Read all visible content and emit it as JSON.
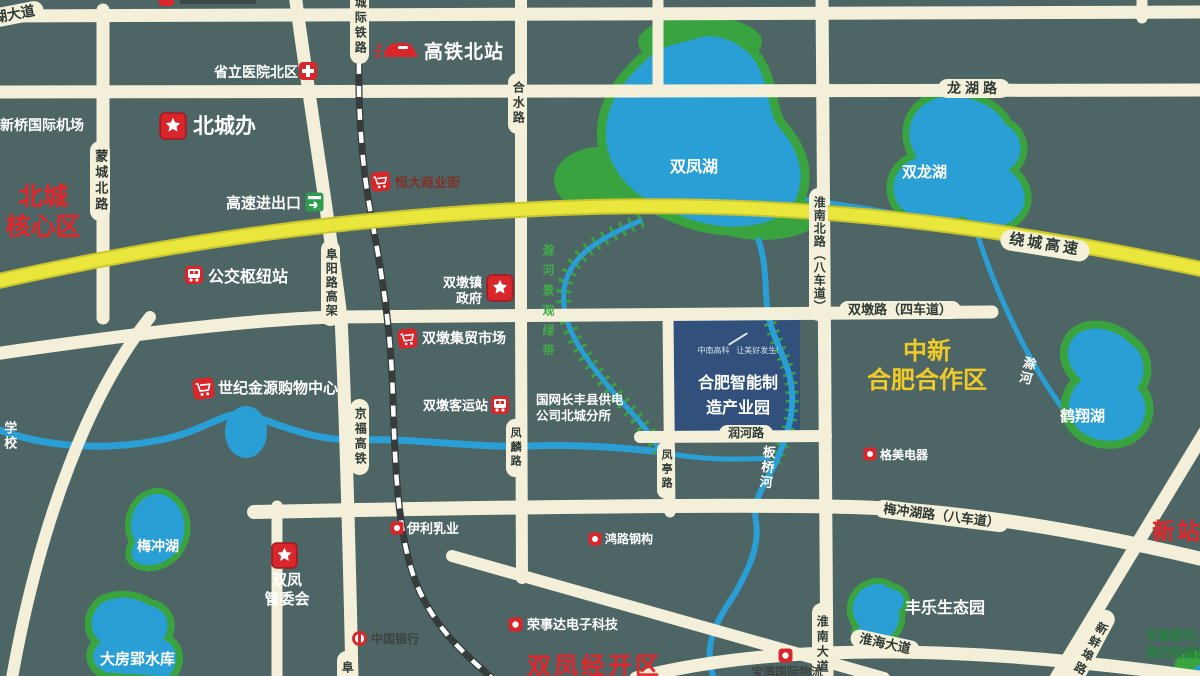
{
  "regions": {
    "beicheng_core": {
      "line1": "北城",
      "line2": "核心区"
    },
    "zhongxin_coop": {
      "line1": "中新",
      "line2": "合肥合作区"
    },
    "xinzhan": {
      "label": "新站区"
    },
    "shuangfeng_edz": {
      "label": "双凤经开区"
    }
  },
  "park": {
    "logo": "中南高科",
    "slogan": "让美好发生!",
    "name_line1": "合肥智能制",
    "name_line2": "造产业园"
  },
  "lakes": {
    "shuangfeng": "双凤湖",
    "shuanglong": "双龙湖",
    "hexiang": "鹤翔湖",
    "meichong": "梅冲湖",
    "dafangying": "大房郢水库"
  },
  "rivers": {
    "banqiao": "板桥河",
    "chu": "滁河",
    "greenway": "滁河景观绿带"
  },
  "roads": {
    "hudadao": "湖大道",
    "longhu": "龙湖路",
    "mengchengbei": "蒙城北路",
    "heshui": "合水路",
    "fuyang_viaduct": "阜阳路高架",
    "fuyang_partial": "阜",
    "chengji_railway": "城际铁路",
    "jingfu_hsr": "京福高铁",
    "raocheng_expwy": "绕城高速",
    "expwy_entrance": "高速进出口",
    "huainanbei": "淮南北路（八车道）",
    "shuangdun": "双墩路（四车道）",
    "runhe": "润河路",
    "fenglin": "凤麟路",
    "fengting": "凤亭路",
    "meichonghu_rd": "梅冲湖路（八车道）",
    "huainan_ave": "淮南大道",
    "huaihai_ave": "淮海大道",
    "xinbengbu": "新蚌埠路"
  },
  "pois": {
    "hsr_north_station": {
      "label": "高铁北站"
    },
    "provincial_hospital": {
      "label": "省立医院北区"
    },
    "beichengban": {
      "label": "北城办"
    },
    "xinqiao_airport": {
      "label": "新桥国际机场"
    },
    "hengda_street": {
      "label": "恒大商业街"
    },
    "bus_hub": {
      "label": "公交枢纽站"
    },
    "shuangdun_gov": {
      "line1": "双墩镇",
      "line2": "政府"
    },
    "jimao_market": {
      "label": "双墩集贸市场"
    },
    "shiji_jinyuan": {
      "label": "世纪金源购物中心"
    },
    "keyun_station": {
      "label": "双墩客运站"
    },
    "guowang": {
      "line1": "国网长丰县供电",
      "line2": "公司北城分所"
    },
    "school": {
      "label": "学校"
    },
    "gemei": {
      "label": "格美电器"
    },
    "yili": {
      "label": "伊利乳业"
    },
    "honglu": {
      "label": "鸿路钢构"
    },
    "boc": {
      "label": "中国银行"
    },
    "rongshida": {
      "label": "荣事达电子科技"
    },
    "shuangfeng_mgmt": {
      "line1": "双凤",
      "line2": "管委会"
    },
    "fengle_park": {
      "label": "丰乐生态园"
    },
    "baowan": {
      "label": "宝湾国际物流"
    },
    "anhui_hospital": {
      "line1": "安徽医科大学",
      "line2": "第四附属医院"
    }
  },
  "colors": {
    "background": "#4d6565",
    "road": "#f3efd8",
    "expressway": "#e9e63c",
    "water": "#2a9fd6",
    "green": "#39a33f",
    "railway": "#353c3b",
    "park_fill": "#31517c",
    "poi_red": "#d8262b",
    "region_red": "#e4252a",
    "region_gold": "#f0ca27"
  }
}
